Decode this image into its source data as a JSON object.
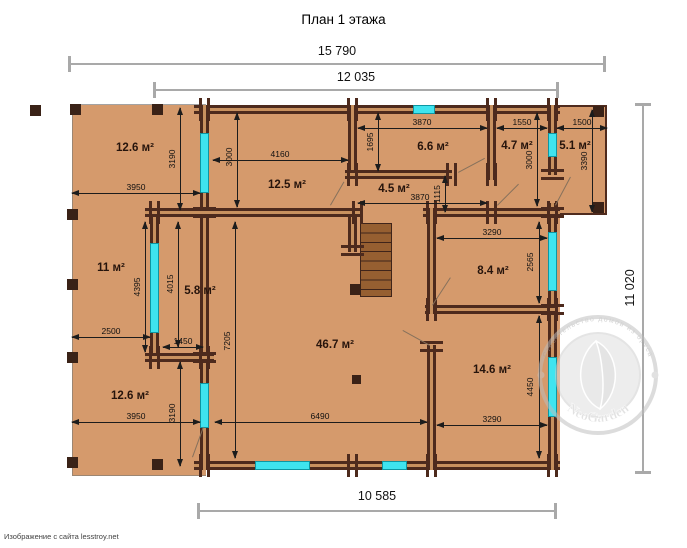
{
  "title": "План 1 этажа",
  "footer": "Изображение с сайта lesstroy.net",
  "watermark": {
    "arc_text": "Строительство домов из бруса",
    "name": "NeoGarden"
  },
  "colors": {
    "floor": "#d59a6c",
    "wall": "#4d2a1d",
    "window": "#3fe4ef",
    "dim_gray": "#a9a9a9"
  },
  "overall_dims": {
    "top_outer": "15 790",
    "top_inner": "12 035",
    "right": "11 020",
    "bottom": "10 585"
  },
  "rooms": {
    "r126_top": "12.6 м²",
    "r125": "12.5 м²",
    "r66": "6.6 м²",
    "r47": "4.7 м²",
    "r51": "5.1 м²",
    "r45": "4.5 м²",
    "r11": "11 м²",
    "r58": "5.8 м²",
    "r84": "8.4 м²",
    "r467": "46.7 м²",
    "r146": "14.6 м²",
    "r126_bottom": "12.6 м²"
  },
  "dims": {
    "d3950_top": "3950",
    "d3190_top": "3190",
    "d3000_left": "3000",
    "d4160": "4160",
    "d1695": "1695",
    "d3870_top": "3870",
    "d1550": "1550",
    "d1500": "1500",
    "d3000_right": "3000",
    "d3390": "3390",
    "d3870_mid": "3870",
    "d1115": "1115",
    "d2500": "2500",
    "d4395": "4395",
    "d4015": "4015",
    "d1450": "1450",
    "d7205": "7205",
    "d3290_top": "3290",
    "d2565": "2565",
    "d3950_bottom": "3950",
    "d3190_bottom": "3190",
    "d6490": "6490",
    "d3290_bottom": "3290",
    "d4450": "4450"
  }
}
